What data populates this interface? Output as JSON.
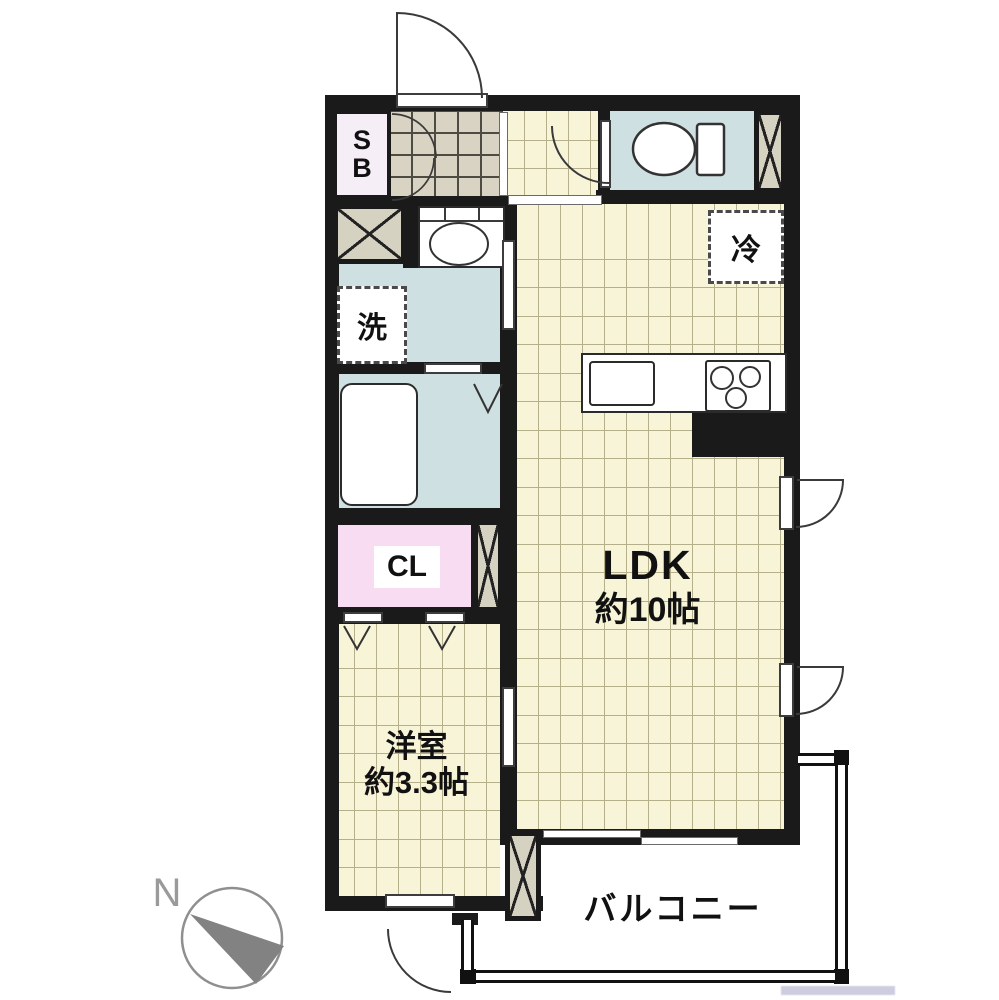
{
  "floorplan": {
    "compass": {
      "north_label": "N"
    },
    "rooms": {
      "ldk": {
        "name": "LDK",
        "area": "約10帖"
      },
      "western": {
        "name": "洋室",
        "area": "約3.3帖"
      },
      "balcony": {
        "name": "バルコニー"
      },
      "closet": {
        "label": "CL"
      },
      "shoebox": {
        "letter_top": "S",
        "letter_bottom": "B"
      },
      "laundry": {
        "label": "洗"
      },
      "fridge": {
        "label": "冷"
      }
    },
    "colors": {
      "wall": "#1a1a1a",
      "wood": "#f8f4d8",
      "wood_line": "#b5b08a",
      "tile": "#d8d3c2",
      "tile_line": "#4d4b42",
      "water": "#cfe0e3",
      "closet_pink": "#f8dcf2",
      "shoebox_pink": "#f6eef6",
      "hatch": "#d6d2c1",
      "compass_gray": "#828282"
    }
  }
}
